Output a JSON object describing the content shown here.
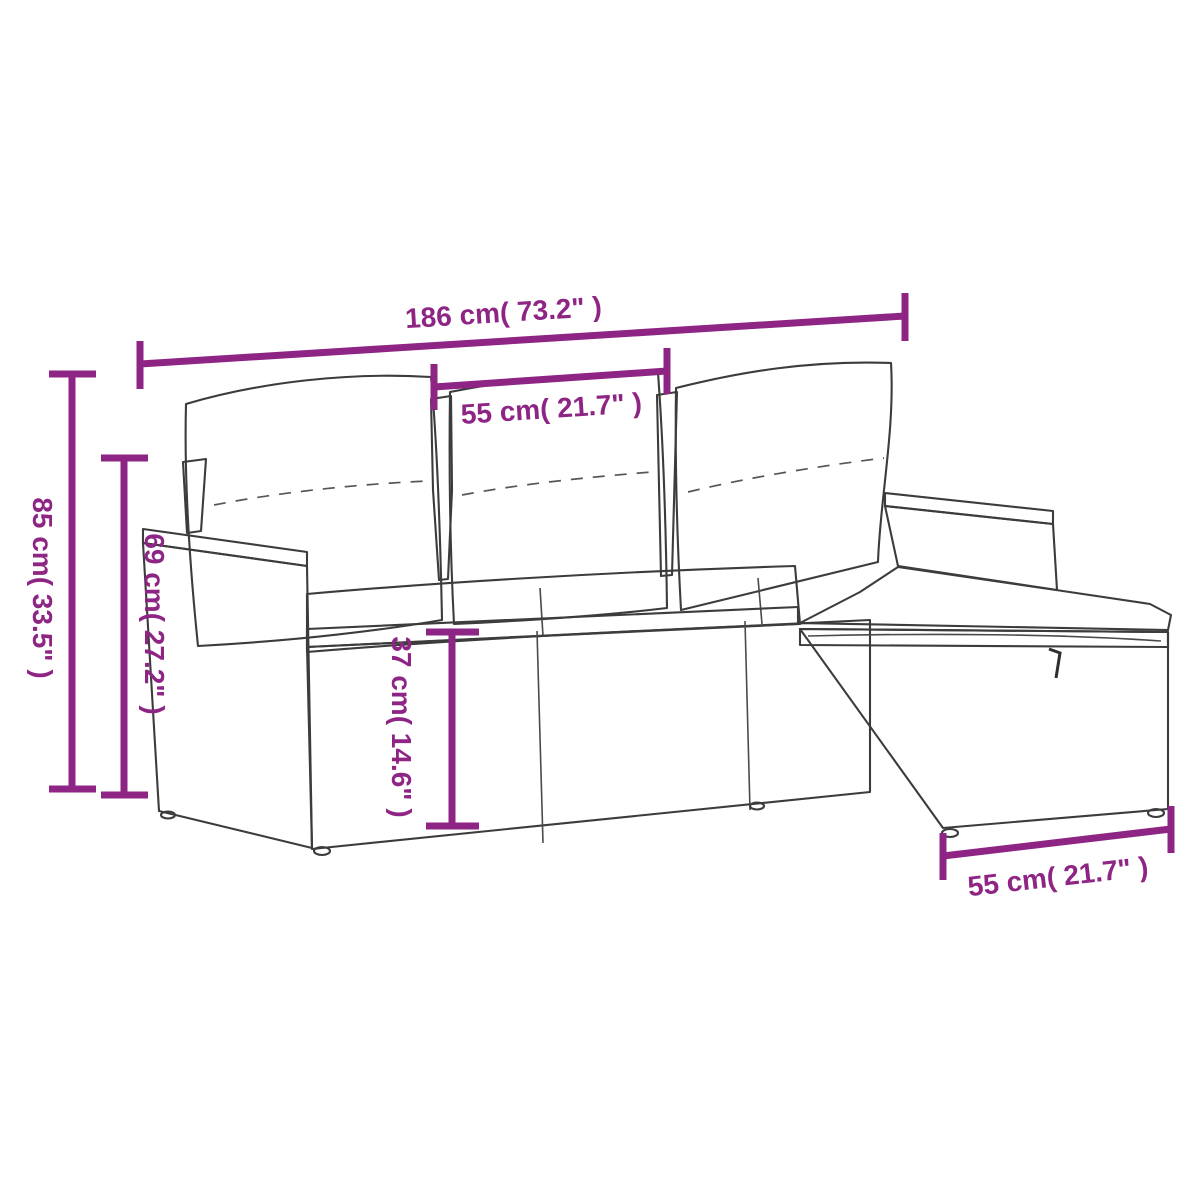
{
  "page": {
    "background_color": "#ffffff"
  },
  "diagram": {
    "kind": "furniture-dimension-diagram",
    "subject": "poly rattan garden sofa set with cushions and storage footstool",
    "accent_color": "#8e2585",
    "sketch_color": "#3c3c3c",
    "dimensions": [
      {
        "id": "overall-width",
        "label": "186 cm( 73.2\" )",
        "orientation": "horizontal"
      },
      {
        "id": "seat-section-width",
        "label": "55 cm( 21.7\" )",
        "orientation": "horizontal"
      },
      {
        "id": "overall-height",
        "label": "85 cm( 33.5\" )",
        "orientation": "vertical"
      },
      {
        "id": "armrest-height",
        "label": "69 cm( 27.2\" )",
        "orientation": "vertical"
      },
      {
        "id": "seat-height",
        "label": "37 cm( 14.6\" )",
        "orientation": "vertical"
      },
      {
        "id": "footstool-width",
        "label": "55 cm( 21.7\" )",
        "orientation": "horizontal"
      }
    ]
  }
}
